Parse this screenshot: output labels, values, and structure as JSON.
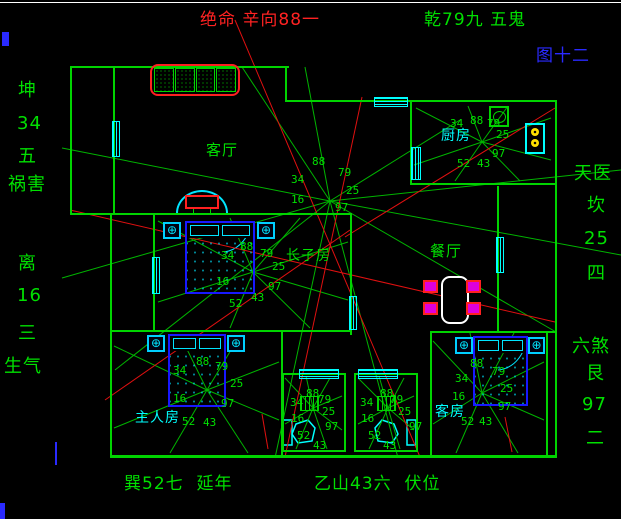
{
  "meta": {
    "app": "feng-shui floor plan drawing",
    "figure_no": "图十二"
  },
  "colors": {
    "bg": "#000000",
    "wall": "#00d400",
    "green": "#00e000",
    "cyan": "#00ffff",
    "red": "#ff2222",
    "blue": "#2a2aff",
    "spoke": "#00b400",
    "red_line": "#e01010"
  },
  "icons": {
    "lamp": "⊕"
  },
  "labels": [
    {
      "text": "绝命 辛向88一",
      "x": 200,
      "y": 12,
      "color": "#ff2222",
      "size": 17
    },
    {
      "text": "乾79九 五鬼",
      "x": 424,
      "y": 12,
      "color": "#00e000",
      "size": 17
    },
    {
      "text": "图十二",
      "x": 536,
      "y": 48,
      "color": "#2a2aff",
      "size": 17
    },
    {
      "text": "坤",
      "x": 18,
      "y": 82,
      "color": "#00e000",
      "size": 18
    },
    {
      "text": "34",
      "x": 17,
      "y": 115,
      "color": "#00e000",
      "size": 18
    },
    {
      "text": "五",
      "x": 18,
      "y": 148,
      "color": "#00e000",
      "size": 18
    },
    {
      "text": "祸害",
      "x": 8,
      "y": 176,
      "color": "#00e000",
      "size": 18
    },
    {
      "text": "离",
      "x": 18,
      "y": 255,
      "color": "#00e000",
      "size": 18
    },
    {
      "text": "16",
      "x": 17,
      "y": 287,
      "color": "#00e000",
      "size": 18
    },
    {
      "text": "三",
      "x": 18,
      "y": 325,
      "color": "#00e000",
      "size": 18
    },
    {
      "text": "生气",
      "x": 4,
      "y": 358,
      "color": "#00e000",
      "size": 18
    },
    {
      "text": "天医",
      "x": 574,
      "y": 165,
      "color": "#00e000",
      "size": 18
    },
    {
      "text": "坎",
      "x": 587,
      "y": 197,
      "color": "#00e000",
      "size": 18
    },
    {
      "text": "25",
      "x": 584,
      "y": 230,
      "color": "#00e000",
      "size": 18
    },
    {
      "text": "四",
      "x": 587,
      "y": 265,
      "color": "#00e000",
      "size": 18
    },
    {
      "text": "六煞",
      "x": 572,
      "y": 338,
      "color": "#00e000",
      "size": 18
    },
    {
      "text": "艮",
      "x": 586,
      "y": 365,
      "color": "#00e000",
      "size": 18
    },
    {
      "text": "97",
      "x": 582,
      "y": 396,
      "color": "#00e000",
      "size": 18
    },
    {
      "text": "二",
      "x": 586,
      "y": 430,
      "color": "#00e000",
      "size": 18
    },
    {
      "text": "巽52七  延年",
      "x": 124,
      "y": 476,
      "color": "#00e000",
      "size": 17
    },
    {
      "text": "乙山43六  伏位",
      "x": 314,
      "y": 476,
      "color": "#00e000",
      "size": 17
    },
    {
      "text": "客厅",
      "x": 206,
      "y": 143,
      "color": "#00e000",
      "size": 15
    },
    {
      "text": "厨房",
      "x": 441,
      "y": 129,
      "color": "#00ffff",
      "size": 14
    },
    {
      "text": "餐厅",
      "x": 430,
      "y": 244,
      "color": "#00e000",
      "size": 15
    },
    {
      "text": "长子房",
      "x": 286,
      "y": 249,
      "color": "#00e000",
      "size": 14
    },
    {
      "text": "主人房",
      "x": 135,
      "y": 411,
      "color": "#00ffff",
      "size": 14
    },
    {
      "text": "客房",
      "x": 435,
      "y": 405,
      "color": "#00ffff",
      "size": 14
    }
  ],
  "charts": [
    {
      "name": "house-center",
      "cx": 330,
      "cy": 201,
      "spokes": [
        [
          242,
          67
        ],
        [
          305,
          67
        ],
        [
          460,
          120
        ],
        [
          621,
          170
        ],
        [
          621,
          255
        ],
        [
          62,
          148
        ],
        [
          62,
          278
        ],
        [
          115,
          370
        ],
        [
          275,
          458
        ],
        [
          398,
          458
        ],
        [
          556,
          332
        ]
      ],
      "numbers": [
        {
          "v": "88",
          "x": 312,
          "y": 156
        },
        {
          "v": "79",
          "x": 338,
          "y": 167
        },
        {
          "v": "34",
          "x": 291,
          "y": 174
        },
        {
          "v": "25",
          "x": 346,
          "y": 185
        },
        {
          "v": "16",
          "x": 291,
          "y": 194
        },
        {
          "v": "97",
          "x": 335,
          "y": 202
        }
      ]
    },
    {
      "name": "kitchen",
      "cx": 482,
      "cy": 142,
      "spokes": [
        [
          416,
          108
        ],
        [
          468,
          106
        ],
        [
          508,
          106
        ],
        [
          551,
          118
        ],
        [
          551,
          160
        ],
        [
          520,
          181
        ],
        [
          455,
          181
        ],
        [
          414,
          165
        ]
      ],
      "numbers": [
        {
          "v": "34",
          "x": 450,
          "y": 118
        },
        {
          "v": "88",
          "x": 470,
          "y": 115
        },
        {
          "v": "79",
          "x": 487,
          "y": 118
        },
        {
          "v": "25",
          "x": 496,
          "y": 129
        },
        {
          "v": "97",
          "x": 492,
          "y": 148
        },
        {
          "v": "43",
          "x": 477,
          "y": 158
        },
        {
          "v": "52",
          "x": 457,
          "y": 158
        }
      ]
    },
    {
      "name": "eldest-son-room",
      "cx": 253,
      "cy": 272,
      "spokes": [
        [
          158,
          221
        ],
        [
          230,
          218
        ],
        [
          300,
          218
        ],
        [
          348,
          242
        ],
        [
          348,
          300
        ],
        [
          310,
          328
        ],
        [
          230,
          328
        ],
        [
          158,
          302
        ]
      ],
      "numbers": [
        {
          "v": "88",
          "x": 240,
          "y": 241
        },
        {
          "v": "79",
          "x": 260,
          "y": 248
        },
        {
          "v": "34",
          "x": 221,
          "y": 250
        },
        {
          "v": "25",
          "x": 272,
          "y": 261
        },
        {
          "v": "16",
          "x": 216,
          "y": 276
        },
        {
          "v": "97",
          "x": 268,
          "y": 281
        },
        {
          "v": "43",
          "x": 251,
          "y": 292
        },
        {
          "v": "52",
          "x": 229,
          "y": 298
        }
      ]
    },
    {
      "name": "master-room",
      "cx": 207,
      "cy": 390,
      "spokes": [
        [
          114,
          346
        ],
        [
          180,
          335
        ],
        [
          240,
          335
        ],
        [
          279,
          362
        ],
        [
          279,
          420
        ],
        [
          248,
          453
        ],
        [
          170,
          453
        ],
        [
          114,
          428
        ]
      ],
      "numbers": [
        {
          "v": "88",
          "x": 196,
          "y": 356
        },
        {
          "v": "79",
          "x": 215,
          "y": 361
        },
        {
          "v": "34",
          "x": 173,
          "y": 365
        },
        {
          "v": "25",
          "x": 230,
          "y": 378
        },
        {
          "v": "16",
          "x": 173,
          "y": 393
        },
        {
          "v": "97",
          "x": 221,
          "y": 398
        },
        {
          "v": "52",
          "x": 182,
          "y": 416
        },
        {
          "v": "43",
          "x": 203,
          "y": 417
        }
      ]
    },
    {
      "name": "bath-left",
      "cx": 313,
      "cy": 408,
      "spokes": [
        [
          285,
          378
        ],
        [
          306,
          376
        ],
        [
          330,
          378
        ],
        [
          342,
          396
        ],
        [
          342,
          430
        ],
        [
          327,
          449
        ],
        [
          296,
          449
        ],
        [
          285,
          424
        ]
      ],
      "numbers": [
        {
          "v": "88",
          "x": 306,
          "y": 388
        },
        {
          "v": "79",
          "x": 318,
          "y": 394
        },
        {
          "v": "34",
          "x": 290,
          "y": 397
        },
        {
          "v": "25",
          "x": 322,
          "y": 406
        },
        {
          "v": "16",
          "x": 291,
          "y": 413
        },
        {
          "v": "97",
          "x": 325,
          "y": 421
        },
        {
          "v": "52",
          "x": 297,
          "y": 430
        },
        {
          "v": "43",
          "x": 313,
          "y": 440
        }
      ]
    },
    {
      "name": "bath-right",
      "cx": 388,
      "cy": 408,
      "spokes": [
        [
          358,
          378
        ],
        [
          379,
          376
        ],
        [
          404,
          378
        ],
        [
          414,
          396
        ],
        [
          414,
          430
        ],
        [
          400,
          449
        ],
        [
          369,
          449
        ],
        [
          358,
          424
        ]
      ],
      "numbers": [
        {
          "v": "88",
          "x": 380,
          "y": 388
        },
        {
          "v": "79",
          "x": 390,
          "y": 394
        },
        {
          "v": "34",
          "x": 360,
          "y": 397
        },
        {
          "v": "25",
          "x": 398,
          "y": 406
        },
        {
          "v": "16",
          "x": 361,
          "y": 413
        },
        {
          "v": "97",
          "x": 409,
          "y": 421
        },
        {
          "v": "52",
          "x": 368,
          "y": 430
        },
        {
          "v": "43",
          "x": 383,
          "y": 440
        }
      ]
    },
    {
      "name": "guest-room",
      "cx": 482,
      "cy": 393,
      "spokes": [
        [
          433,
          341
        ],
        [
          470,
          333
        ],
        [
          514,
          333
        ],
        [
          544,
          362
        ],
        [
          544,
          420
        ],
        [
          518,
          453
        ],
        [
          456,
          453
        ],
        [
          433,
          424
        ]
      ],
      "numbers": [
        {
          "v": "88",
          "x": 470,
          "y": 358
        },
        {
          "v": "34",
          "x": 455,
          "y": 373
        },
        {
          "v": "79",
          "x": 492,
          "y": 366
        },
        {
          "v": "25",
          "x": 500,
          "y": 383
        },
        {
          "v": "16",
          "x": 452,
          "y": 391
        },
        {
          "v": "97",
          "x": 498,
          "y": 401
        },
        {
          "v": "52",
          "x": 461,
          "y": 416
        },
        {
          "v": "43",
          "x": 479,
          "y": 416
        }
      ]
    }
  ],
  "red_lines": [
    [
      235,
      20,
      420,
      457
    ],
    [
      70,
      210,
      555,
      322
    ],
    [
      285,
      457,
      362,
      97
    ],
    [
      345,
      237,
      555,
      108
    ],
    [
      105,
      400,
      350,
      230
    ],
    [
      262,
      414,
      268,
      449
    ],
    [
      505,
      417,
      512,
      452
    ]
  ],
  "edge_marks": [
    {
      "x": 0,
      "y": 2,
      "w": 621,
      "h": 1,
      "c": "#ffffff"
    },
    {
      "x": 2,
      "y": 32,
      "w": 7,
      "h": 14,
      "c": "#2a2aff"
    },
    {
      "x": 55,
      "y": 442,
      "w": 2,
      "h": 23,
      "c": "#2a2aff"
    },
    {
      "x": 0,
      "y": 503,
      "w": 5,
      "h": 16,
      "c": "#2a2aff"
    }
  ]
}
